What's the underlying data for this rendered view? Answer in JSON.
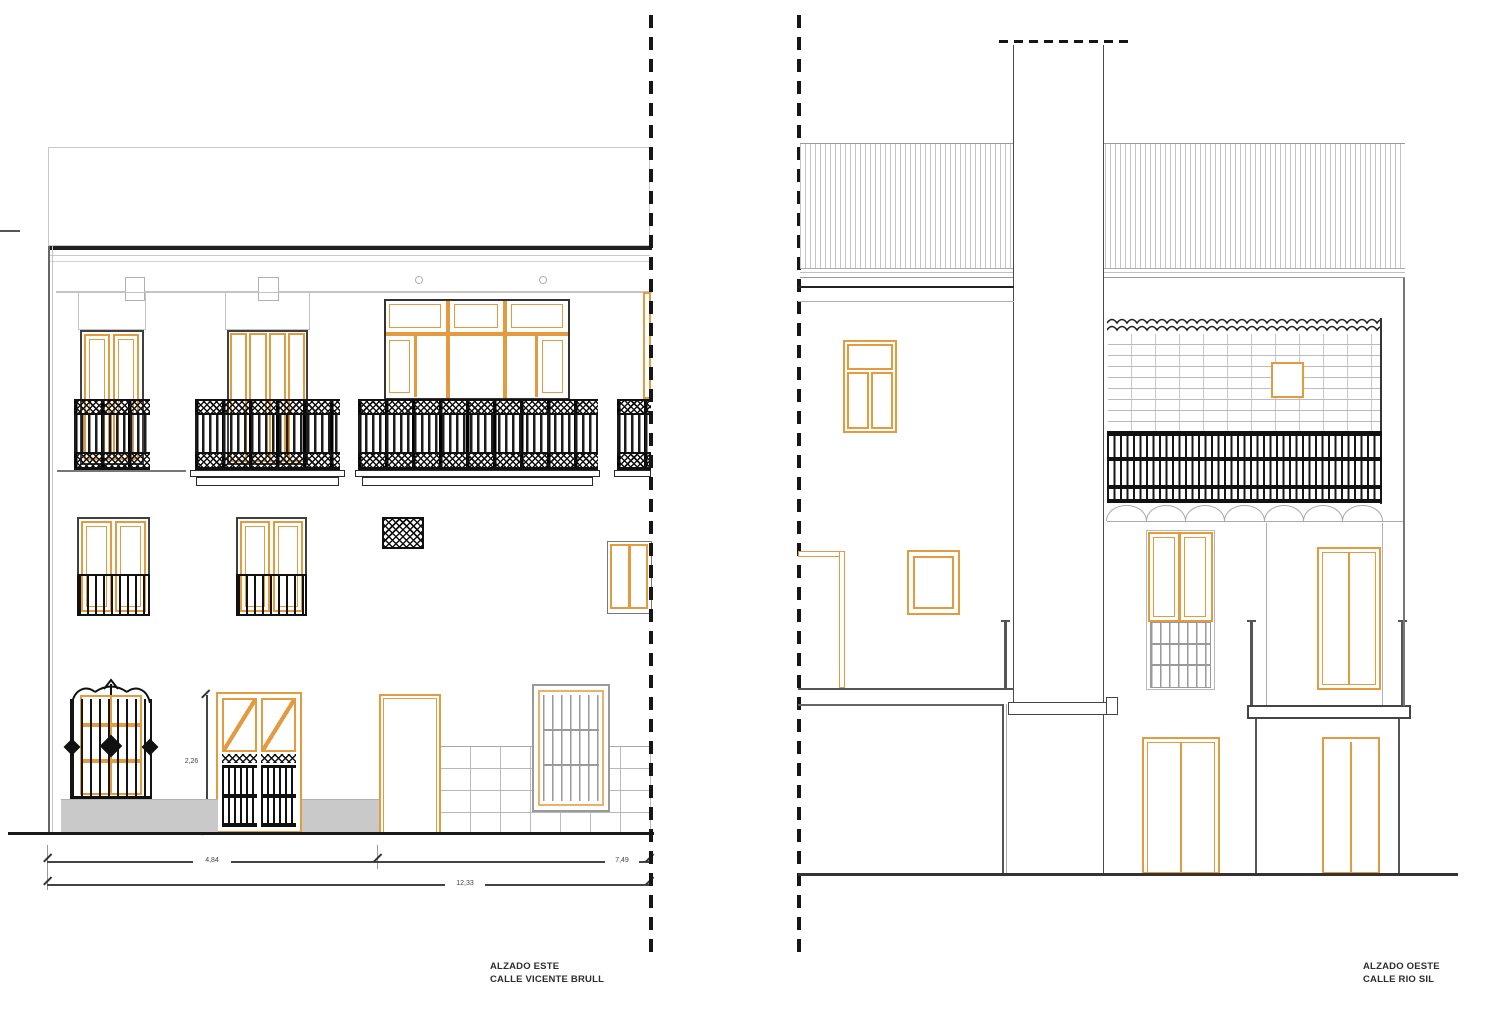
{
  "sheet": {
    "left_elevation": {
      "title": "ALZADO ESTE",
      "subtitle": "CALLE VICENTE BRULL",
      "dimensions": {
        "door_height": "2,26",
        "span_left": "4,84",
        "span_right": "7,49",
        "span_total": "12,33"
      }
    },
    "right_elevation": {
      "title": "ALZADO OESTE",
      "subtitle": "CALLE RIO SIL"
    },
    "colors": {
      "carpentry_orange": "#E49B40",
      "ironwork_black": "#161616",
      "line_grey": "#9B9B9B",
      "pavement_grey": "#C9C9C9"
    }
  }
}
